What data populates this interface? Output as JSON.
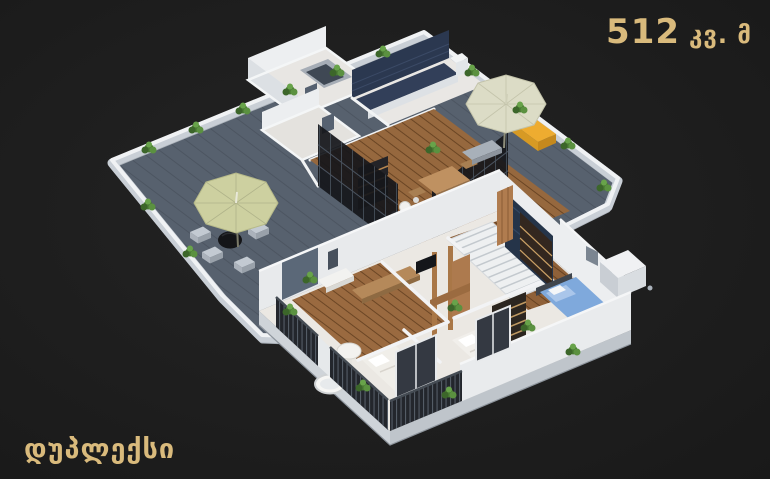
{
  "canvas": {
    "width": 770,
    "height": 479,
    "background": "#1e1e1e"
  },
  "area_label": {
    "value": "512",
    "unit": "კვ. მ",
    "color": "#d9ba7c"
  },
  "title_label": {
    "text": "დუპლექსი",
    "color": "#d9ba7c"
  },
  "scene": {
    "kind": "3D isometric cutaway floor plan of a duplex apartment, two stacked levels",
    "upper_floor": {
      "label": "upper level with roof terrace",
      "features": [
        "wrap-around roof terrace with dark plank decking",
        "white parapet walls lined with green planters",
        "olive patio umbrella with black bistro table and four grey poufs",
        "cream patio umbrella",
        "yellow garden bench",
        "grey lounger cushion",
        "two small white utility rooms and lift shaft",
        "kitchen with navy tile backsplash and white counters",
        "wood-floored open living and dining room",
        "timber dining table with chairs",
        "dark shelving unit",
        "black-framed glass partition walls"
      ]
    },
    "lower_floor": {
      "label": "lower bedroom level",
      "features": [
        "white plaster walls",
        "wood-floored hall and bedrooms",
        "white staircase with timber screen",
        "dark navy marble feature wall",
        "dark wardrobe and striped bookshelf",
        "double bed with blue bedding",
        "two double beds with white bedding",
        "round white pedestal table",
        "timber bench and dresser",
        "bathtub",
        "balconies with dark slatted railings",
        "black-framed glass doors",
        "green planters"
      ]
    },
    "palette": {
      "deck": "#57616e",
      "parapet": "#f0f2f4",
      "wood_floor": "#96683e",
      "glass_frame": "#15171b",
      "kitchen_navy": "#2b3850",
      "marble_navy": "#253449",
      "bench_yellow": "#eeac30",
      "umbrella_olive": "#cdd0a0",
      "umbrella_cream": "#dcdcc6",
      "bed_blue": "#7fa9dc",
      "plant": "#4a7a33",
      "lower_floor_base": "#ebe8e3",
      "railing": "#23262c",
      "wood_furniture": "#b07c4f"
    }
  }
}
